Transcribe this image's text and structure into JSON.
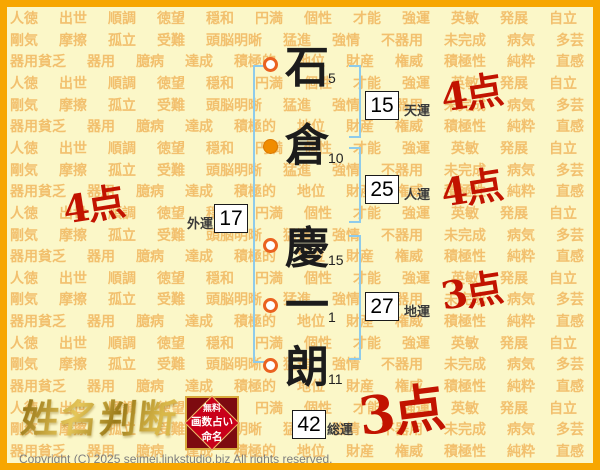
{
  "colors": {
    "page-bg": "#FBF7C8",
    "border": "#F7A600",
    "watermark": "#F2C06E",
    "bracket": "#8ECBEB",
    "score-red": "#C21300",
    "marker-ring": "#EA6220",
    "marker-fill": "#F08C00",
    "box-border": "#1A1A1A",
    "label-text": "#3A3A3A",
    "stamp-red": "#C9001A",
    "stamp-gold": "#D9A93C",
    "copyright-gray": "#7D7D7D"
  },
  "background": {
    "row_count": 21,
    "rows": {
      "a": [
        "人徳",
        "出世",
        "順調",
        "徳望",
        "穏和",
        "円満",
        "個性",
        "才能",
        "強運",
        "英敏",
        "発展",
        "自立"
      ],
      "b": [
        "剛気",
        "摩擦",
        "孤立",
        "受難",
        "頭脳明晰",
        "猛進",
        "強情",
        "不器用",
        "未完成",
        "病気",
        "多芸"
      ],
      "c": [
        "器用貧乏",
        "器用",
        "臆病",
        "達成",
        "積極的",
        "地位",
        "財産",
        "権威",
        "積極性",
        "純粋",
        "直感"
      ]
    }
  },
  "name_chart": {
    "characters": [
      {
        "char": "石",
        "strokes": "5",
        "marker": "open"
      },
      {
        "char": "倉",
        "strokes": "10",
        "marker": "filled"
      },
      {
        "char": "慶",
        "strokes": "15",
        "marker": "open"
      },
      {
        "char": "一",
        "strokes": "1",
        "marker": "open"
      },
      {
        "char": "朗",
        "strokes": "11",
        "marker": "open"
      }
    ],
    "fortunes": [
      {
        "name": "天運",
        "value": "15",
        "score": "4点"
      },
      {
        "name": "人運",
        "value": "25",
        "score": "4点"
      },
      {
        "name": "外運",
        "value": "17",
        "score": "4点"
      },
      {
        "name": "地運",
        "value": "27",
        "score": "3点"
      },
      {
        "name": "総運",
        "value": "42",
        "score": "3点"
      }
    ]
  },
  "branding": {
    "logo": "姓名判断",
    "stamp": {
      "line1": "無料",
      "line2": "画数占い",
      "line3": "命名"
    }
  },
  "footer": {
    "copyright": "Copyright (C) 2025 seimei.linkstudio.biz All rights reserved."
  }
}
